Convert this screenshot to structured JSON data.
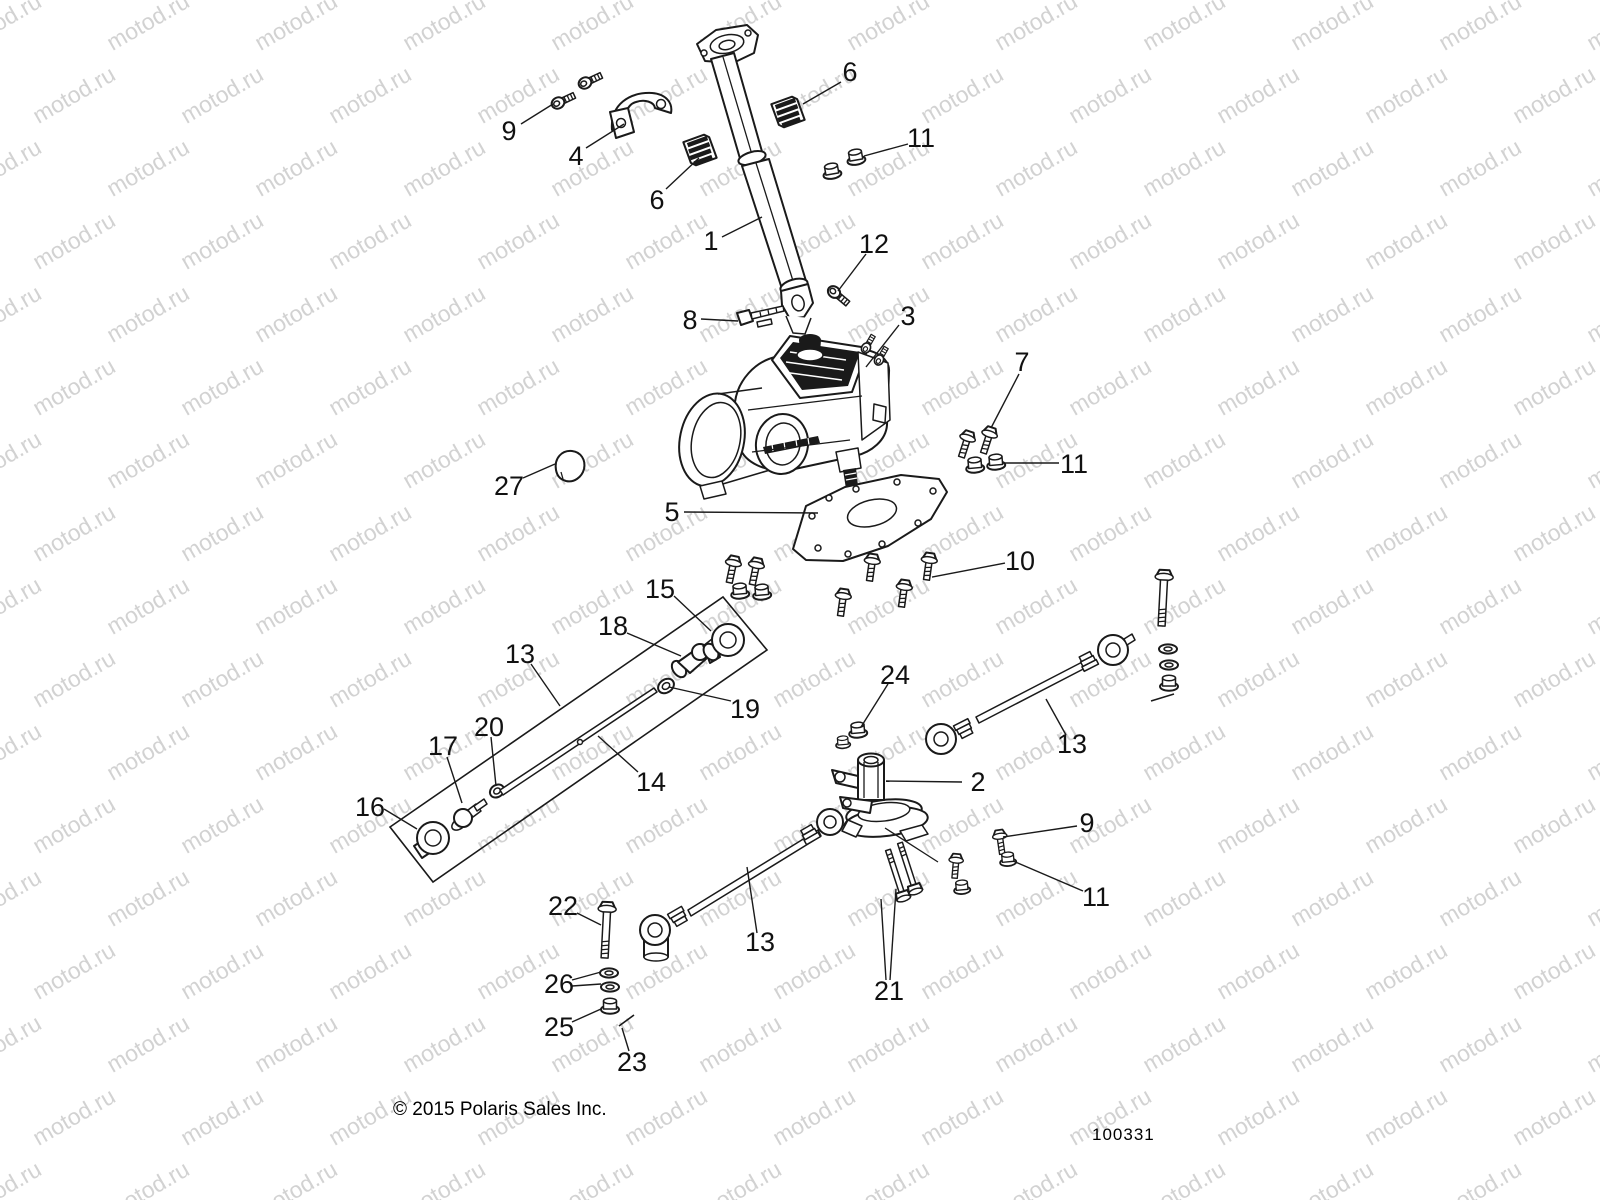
{
  "watermark": {
    "text": "motod.ru",
    "color": "#d2d2d2",
    "font_size_px": 23,
    "angle_deg": -30,
    "col_spacing_px": 148,
    "row_spacing_px": 73,
    "row_stagger_px": 74,
    "cols": 13,
    "rows": 18
  },
  "footer": {
    "copyright": "© 2015 Polaris Sales Inc.",
    "diagram_code": "100331"
  },
  "diagram": {
    "description": "Steering assembly exploded parts diagram",
    "line_color": "#1a1a1a",
    "callout_font_px": 27,
    "callouts": [
      {
        "label": "1",
        "x": 711,
        "y": 241,
        "leaders": [
          [
            722,
            237,
            762,
            217
          ]
        ]
      },
      {
        "label": "2",
        "x": 978,
        "y": 782,
        "leaders": [
          [
            962,
            782,
            886,
            781
          ]
        ]
      },
      {
        "label": "3",
        "x": 908,
        "y": 316,
        "leaders": [
          [
            899,
            325,
            866,
            367
          ]
        ]
      },
      {
        "label": "4",
        "x": 576,
        "y": 156,
        "leaders": [
          [
            586,
            148,
            624,
            124
          ]
        ]
      },
      {
        "label": "5",
        "x": 672,
        "y": 512,
        "leaders": [
          [
            684,
            512,
            818,
            513
          ]
        ]
      },
      {
        "label": "6",
        "x": 850,
        "y": 72,
        "leaders": [
          [
            841,
            82,
            803,
            104
          ]
        ]
      },
      {
        "label": "6",
        "x": 657,
        "y": 200,
        "leaders": [
          [
            666,
            189,
            699,
            158
          ]
        ]
      },
      {
        "label": "7",
        "x": 1022,
        "y": 362,
        "leaders": [
          [
            1019,
            374,
            991,
            428
          ]
        ]
      },
      {
        "label": "8",
        "x": 690,
        "y": 320,
        "leaders": [
          [
            701,
            319,
            738,
            321
          ]
        ]
      },
      {
        "label": "9",
        "x": 509,
        "y": 131,
        "leaders": [
          [
            521,
            124,
            553,
            104
          ]
        ]
      },
      {
        "label": "9",
        "x": 1087,
        "y": 823,
        "leaders": [
          [
            1077,
            826,
            1003,
            837
          ]
        ]
      },
      {
        "label": "10",
        "x": 1020,
        "y": 561,
        "leaders": [
          [
            1005,
            563,
            932,
            577
          ]
        ]
      },
      {
        "label": "11",
        "x": 921,
        "y": 138,
        "leaders": [
          [
            908,
            144,
            864,
            156
          ]
        ]
      },
      {
        "label": "11",
        "x": 1074,
        "y": 464,
        "leaders": [
          [
            1059,
            463,
            1003,
            463
          ]
        ]
      },
      {
        "label": "11",
        "x": 1096,
        "y": 897,
        "leaders": [
          [
            1083,
            891,
            1013,
            861
          ]
        ]
      },
      {
        "label": "12",
        "x": 874,
        "y": 244,
        "leaders": [
          [
            866,
            254,
            838,
            291
          ]
        ]
      },
      {
        "label": "13",
        "x": 520,
        "y": 654,
        "leaders": [
          [
            531,
            664,
            560,
            706
          ]
        ]
      },
      {
        "label": "13",
        "x": 1072,
        "y": 744,
        "leaders": [
          [
            1066,
            735,
            1046,
            699
          ]
        ]
      },
      {
        "label": "13",
        "x": 760,
        "y": 942,
        "leaders": [
          [
            757,
            933,
            747,
            867
          ]
        ]
      },
      {
        "label": "14",
        "x": 651,
        "y": 782,
        "leaders": [
          [
            638,
            772,
            598,
            736
          ]
        ]
      },
      {
        "label": "15",
        "x": 660,
        "y": 589,
        "leaders": [
          [
            674,
            596,
            711,
            631
          ]
        ]
      },
      {
        "label": "16",
        "x": 370,
        "y": 807,
        "leaders": [
          [
            384,
            809,
            417,
            829
          ]
        ]
      },
      {
        "label": "17",
        "x": 443,
        "y": 746,
        "leaders": [
          [
            447,
            757,
            462,
            803
          ]
        ]
      },
      {
        "label": "18",
        "x": 613,
        "y": 626,
        "leaders": [
          [
            627,
            633,
            681,
            656
          ]
        ]
      },
      {
        "label": "19",
        "x": 745,
        "y": 709,
        "leaders": [
          [
            731,
            701,
            669,
            687
          ]
        ]
      },
      {
        "label": "20",
        "x": 489,
        "y": 727,
        "leaders": [
          [
            491,
            737,
            496,
            786
          ]
        ]
      },
      {
        "label": "21",
        "x": 889,
        "y": 991,
        "leaders": [
          [
            886,
            980,
            881,
            899
          ],
          [
            890,
            980,
            896,
            889
          ]
        ]
      },
      {
        "label": "22",
        "x": 563,
        "y": 906,
        "leaders": [
          [
            577,
            913,
            601,
            925
          ]
        ]
      },
      {
        "label": "23",
        "x": 632,
        "y": 1062,
        "leaders": [
          [
            629,
            1051,
            622,
            1028
          ]
        ]
      },
      {
        "label": "24",
        "x": 895,
        "y": 675,
        "leaders": [
          [
            888,
            684,
            861,
            727
          ]
        ]
      },
      {
        "label": "25",
        "x": 559,
        "y": 1027,
        "leaders": [
          [
            572,
            1022,
            601,
            1009
          ]
        ]
      },
      {
        "label": "26",
        "x": 559,
        "y": 984,
        "leaders": [
          [
            572,
            980,
            601,
            972
          ],
          [
            572,
            986,
            601,
            984
          ]
        ]
      },
      {
        "label": "27",
        "x": 509,
        "y": 486,
        "leaders": [
          [
            523,
            478,
            555,
            464
          ]
        ]
      }
    ]
  }
}
